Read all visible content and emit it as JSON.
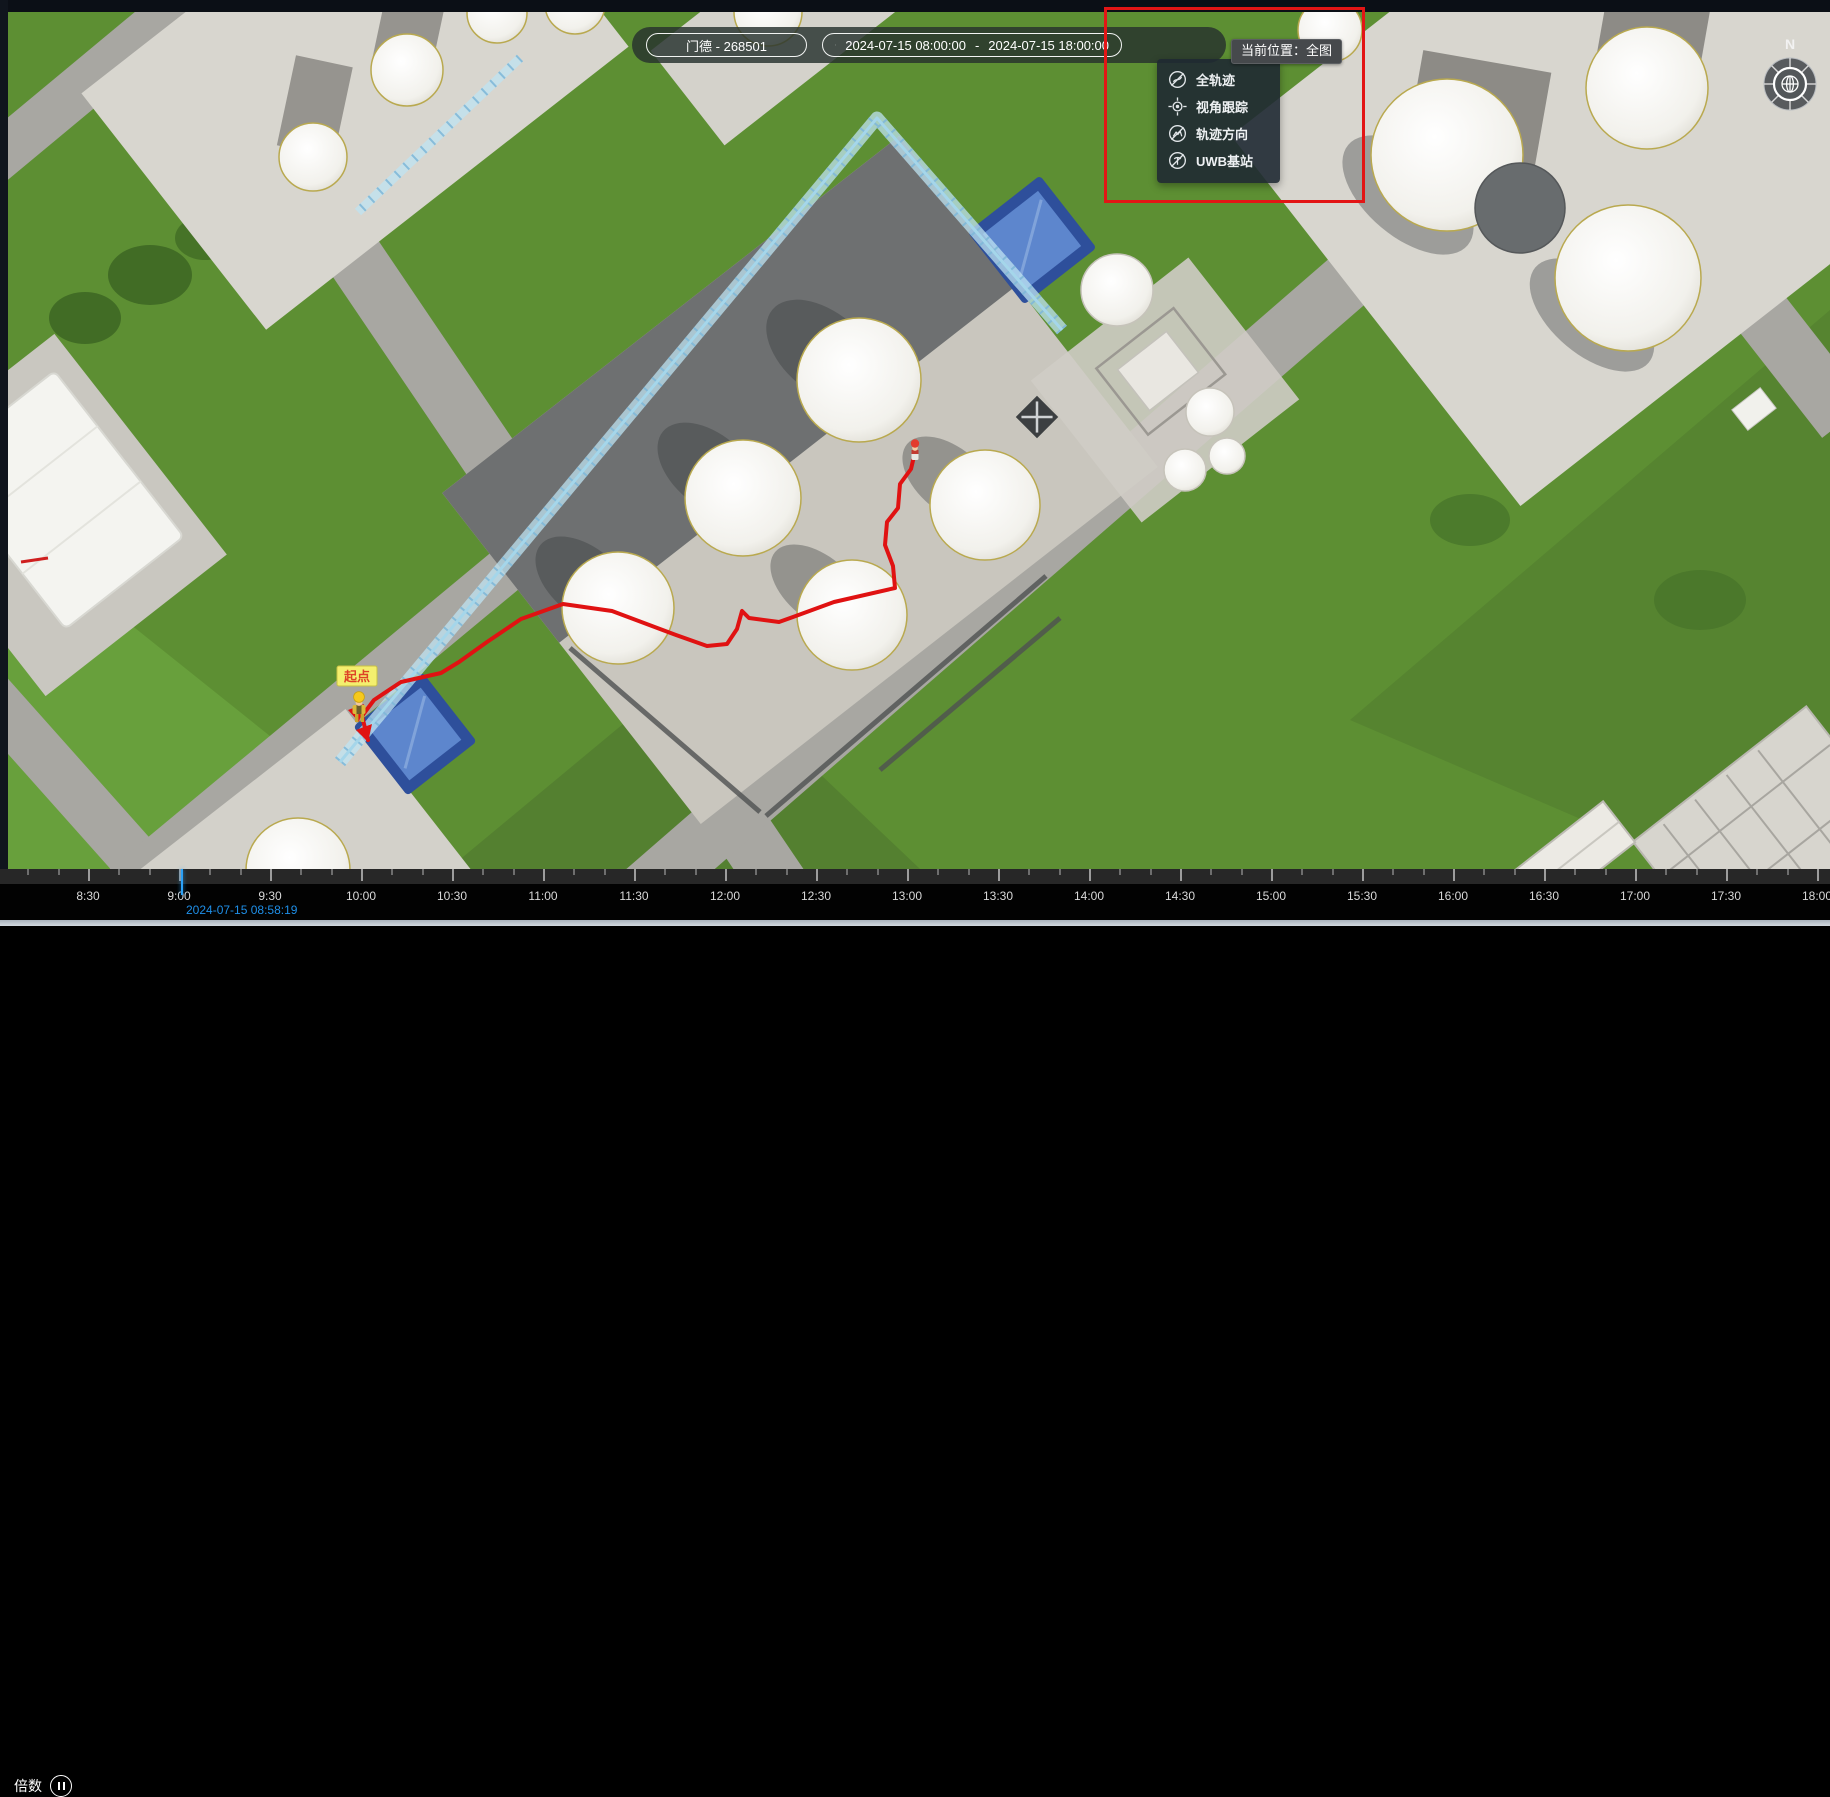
{
  "toolbar": {
    "person_select": {
      "value": "门德 - 268501"
    },
    "time_range": {
      "start": "2024-07-15 08:00:00",
      "separator": "-",
      "end": "2024-07-15 18:00:00"
    }
  },
  "tooltip": {
    "text": "当前位置：全图"
  },
  "view_menu": {
    "items": [
      {
        "label": "全轨迹",
        "icon": "full-trajectory-icon"
      },
      {
        "label": "视角跟踪",
        "icon": "view-follow-icon"
      },
      {
        "label": "轨迹方向",
        "icon": "trajectory-direction-icon"
      },
      {
        "label": "UWB基站",
        "icon": "uwb-station-icon"
      }
    ]
  },
  "map": {
    "start_label": "起点",
    "compass_north": "N"
  },
  "timeline": {
    "speed_label": "倍数",
    "current_time": "2024-07-15 08:58:19",
    "ticks": [
      "8:30",
      "9:00",
      "9:30",
      "10:00",
      "10:30",
      "11:00",
      "11:30",
      "12:00",
      "12:30",
      "13:00",
      "13:30",
      "14:00",
      "14:30",
      "15:00",
      "15:30",
      "16:00",
      "16:30",
      "17:00",
      "17:30",
      "18:00"
    ]
  },
  "colors": {
    "annotation_red": "#e31515",
    "trajectory_red": "#e01212",
    "playhead_blue": "#2ba1f7",
    "timestamp_blue": "#1f8fe8",
    "start_label_yellow": "#f4ef6e"
  }
}
